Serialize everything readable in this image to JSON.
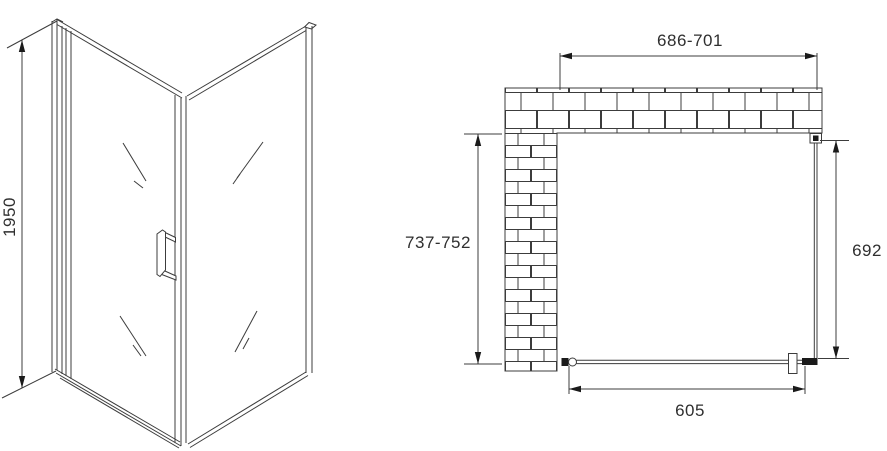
{
  "drawing": {
    "type": "shower-enclosure-installation-diagram",
    "front_view": {
      "height_dimension": "1950"
    },
    "plan_view": {
      "width_dimension": "686-701",
      "depth_dimension": "737-752",
      "side_panel_dimension": "692",
      "door_dimension": "605"
    },
    "colors": {
      "line": "#3c3c3c",
      "text": "#2f2f2f",
      "background": "#ffffff",
      "solid_fill": "#1a1a1a"
    }
  }
}
